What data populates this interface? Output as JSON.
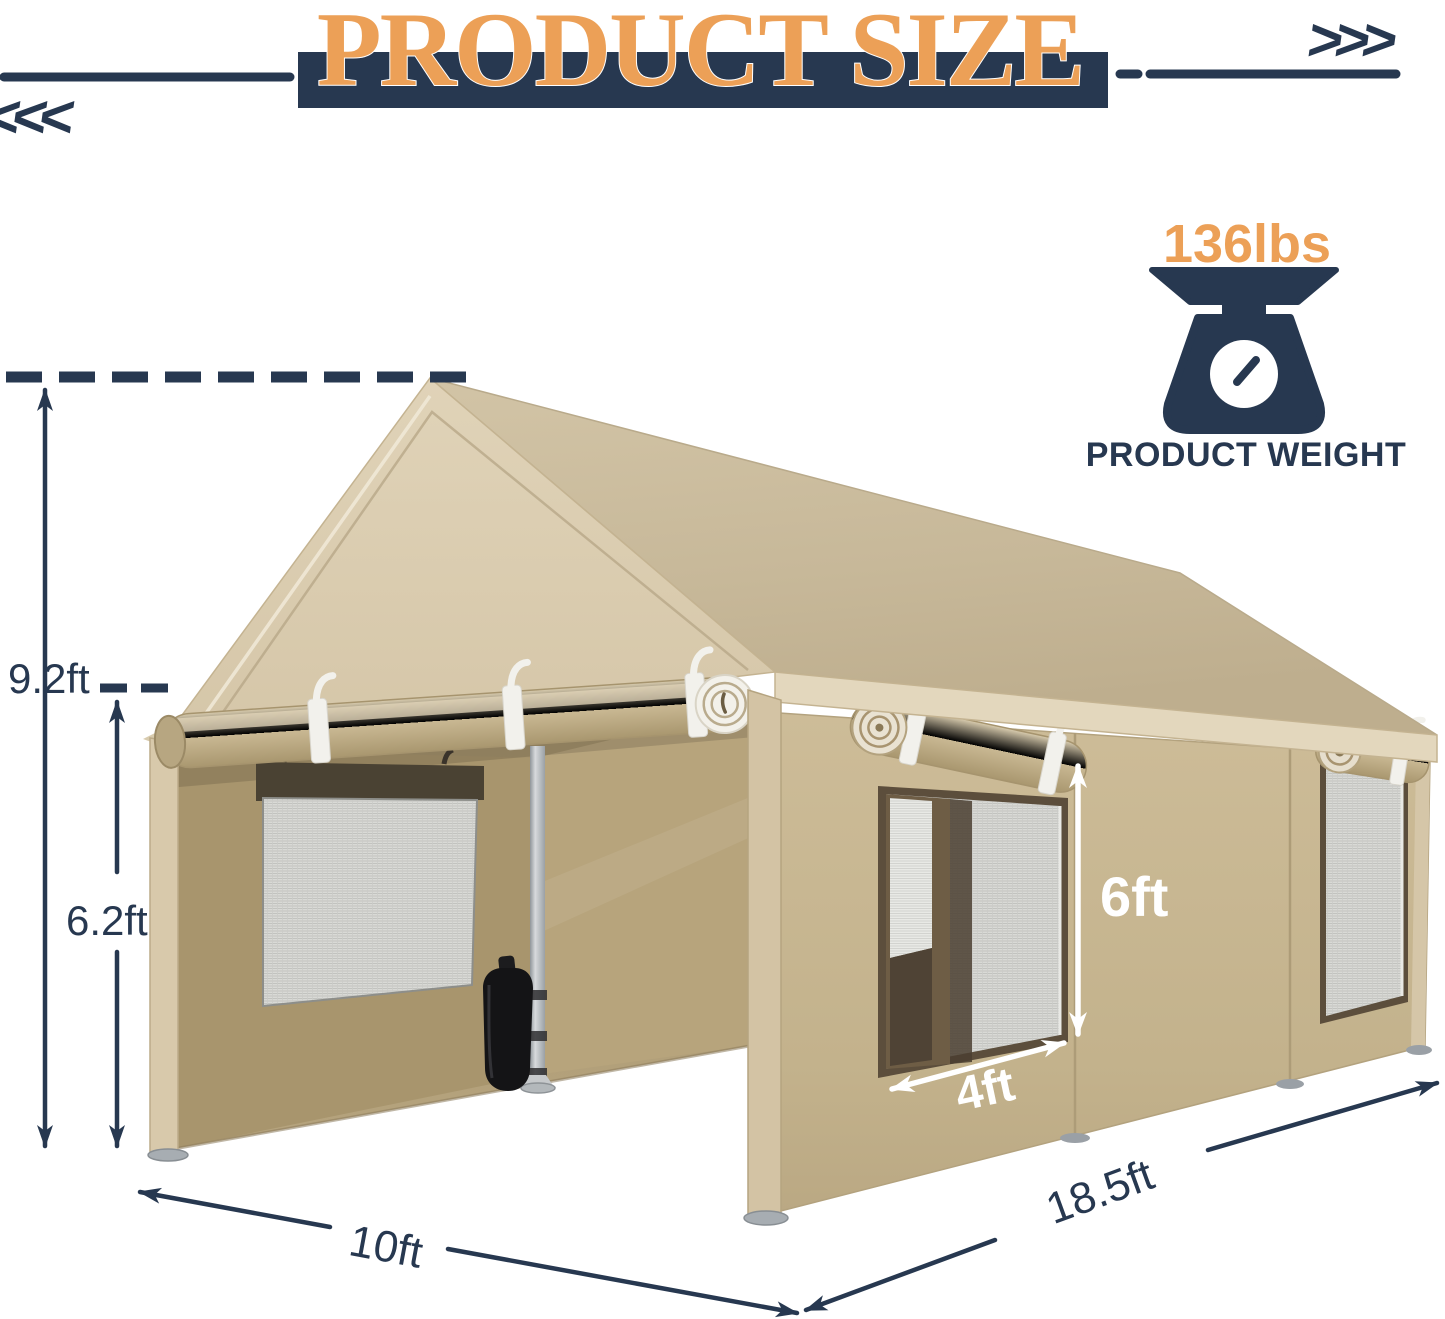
{
  "header": {
    "title": "PRODUCT SIZE",
    "left_chevrons": "<<<",
    "right_chevrons": ">>>"
  },
  "weight_badge": {
    "value": "136lbs",
    "label": "PRODUCT WEIGHT",
    "icon": "weighing-scale-icon"
  },
  "dimensions": {
    "peak_height": "9.2ft",
    "side_height": "6.2ft",
    "front_width": "10ft",
    "side_length": "18.5ft",
    "window_height": "6ft",
    "window_width": "4ft"
  },
  "colors": {
    "navy": "#273850",
    "orange": "#ECA057",
    "tan_canvas": "#CDBB97",
    "tan_interior": "#AC9A72",
    "mesh_gray": "#D9DAD6",
    "white": "#FFFFFF"
  }
}
